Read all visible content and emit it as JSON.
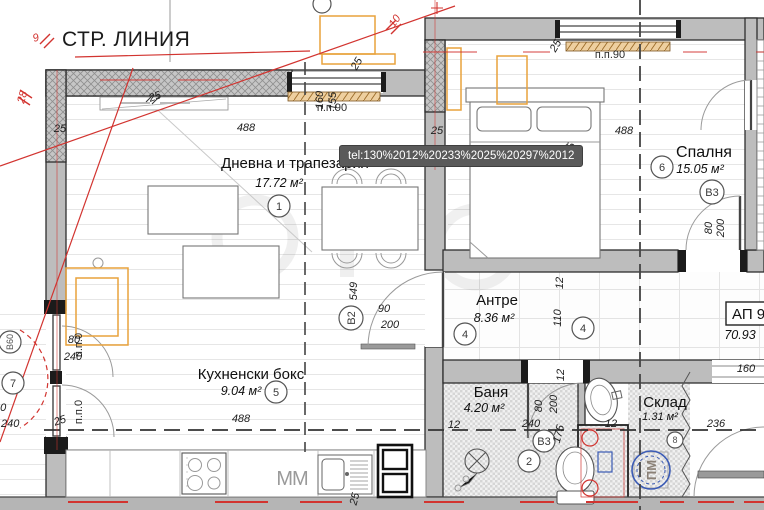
{
  "street_line": "СТР. ЛИНИЯ",
  "tooltip": "tel:130%2012%20233%2025%20297%2012",
  "apartment": {
    "code": "АП 9",
    "total_area": "70.93"
  },
  "rooms": {
    "living": {
      "name": "Дневна и трапезария",
      "area": "17.72 м²",
      "num": "1"
    },
    "bedroom": {
      "name": "Спалня",
      "area": "15.05 м²",
      "num": "6"
    },
    "hall": {
      "name": "Антре",
      "area": "8.36 м²",
      "num": "4"
    },
    "kitchen": {
      "name": "Кухненски бокс",
      "area": "9.04 м²",
      "num": "5"
    },
    "bath": {
      "name": "Баня",
      "area": "4.20 м²",
      "num": "2"
    },
    "storage": {
      "name": "Склад",
      "area": "1.31 м²",
      "num": "8"
    },
    "terrace": {
      "num": "7"
    }
  },
  "markers": {
    "b2": "В2",
    "b3_bedroom": "В3",
    "b3_bath": "В3",
    "b60": "В60",
    "washer": "ПМ",
    "mm": "ММ"
  },
  "sills": {
    "pp90_living": "п.п.90",
    "pp90_bedroom": "п.п.90",
    "pp0_upper": "п.п.0",
    "pp0_lower": "п.п.0"
  },
  "red_marks": {
    "o9": "9",
    "o28": "28",
    "o10": "10"
  },
  "dims": {
    "living_width": "488",
    "bedroom_width": "488",
    "kitchen_width": "488",
    "wall25_a": "25",
    "wall25_b": "25",
    "wall25_c": "25",
    "wall25_d": "25",
    "wall25_e": "25",
    "wall25_f": "25",
    "wall25_g": "25",
    "v160": "160",
    "v155": "155",
    "v549": "549",
    "v375": "375",
    "door90": "90",
    "door200": "200",
    "bed_door80": "80",
    "bed_door200": "200",
    "bath80": "80",
    "bath200": "200",
    "bath175": "175",
    "hall12a": "12",
    "hall110": "110",
    "hall12b": "12",
    "bath12a": "12",
    "bath240": "240",
    "bath12b": "12",
    "storage236": "236",
    "opening160": "160",
    "balc80": "80",
    "balc240": "240",
    "balc80b": "80",
    "balc240b": "240"
  },
  "colors": {
    "wall": "#bdbdbd",
    "wall_dark": "#2e2e2e",
    "red": "#d23430",
    "orange": "#e8a23c",
    "blue": "#3b5bb5",
    "sill": "#eecf9f",
    "tooltip_bg": "#5a5a5a",
    "tooltip_text": "#ffffff"
  }
}
